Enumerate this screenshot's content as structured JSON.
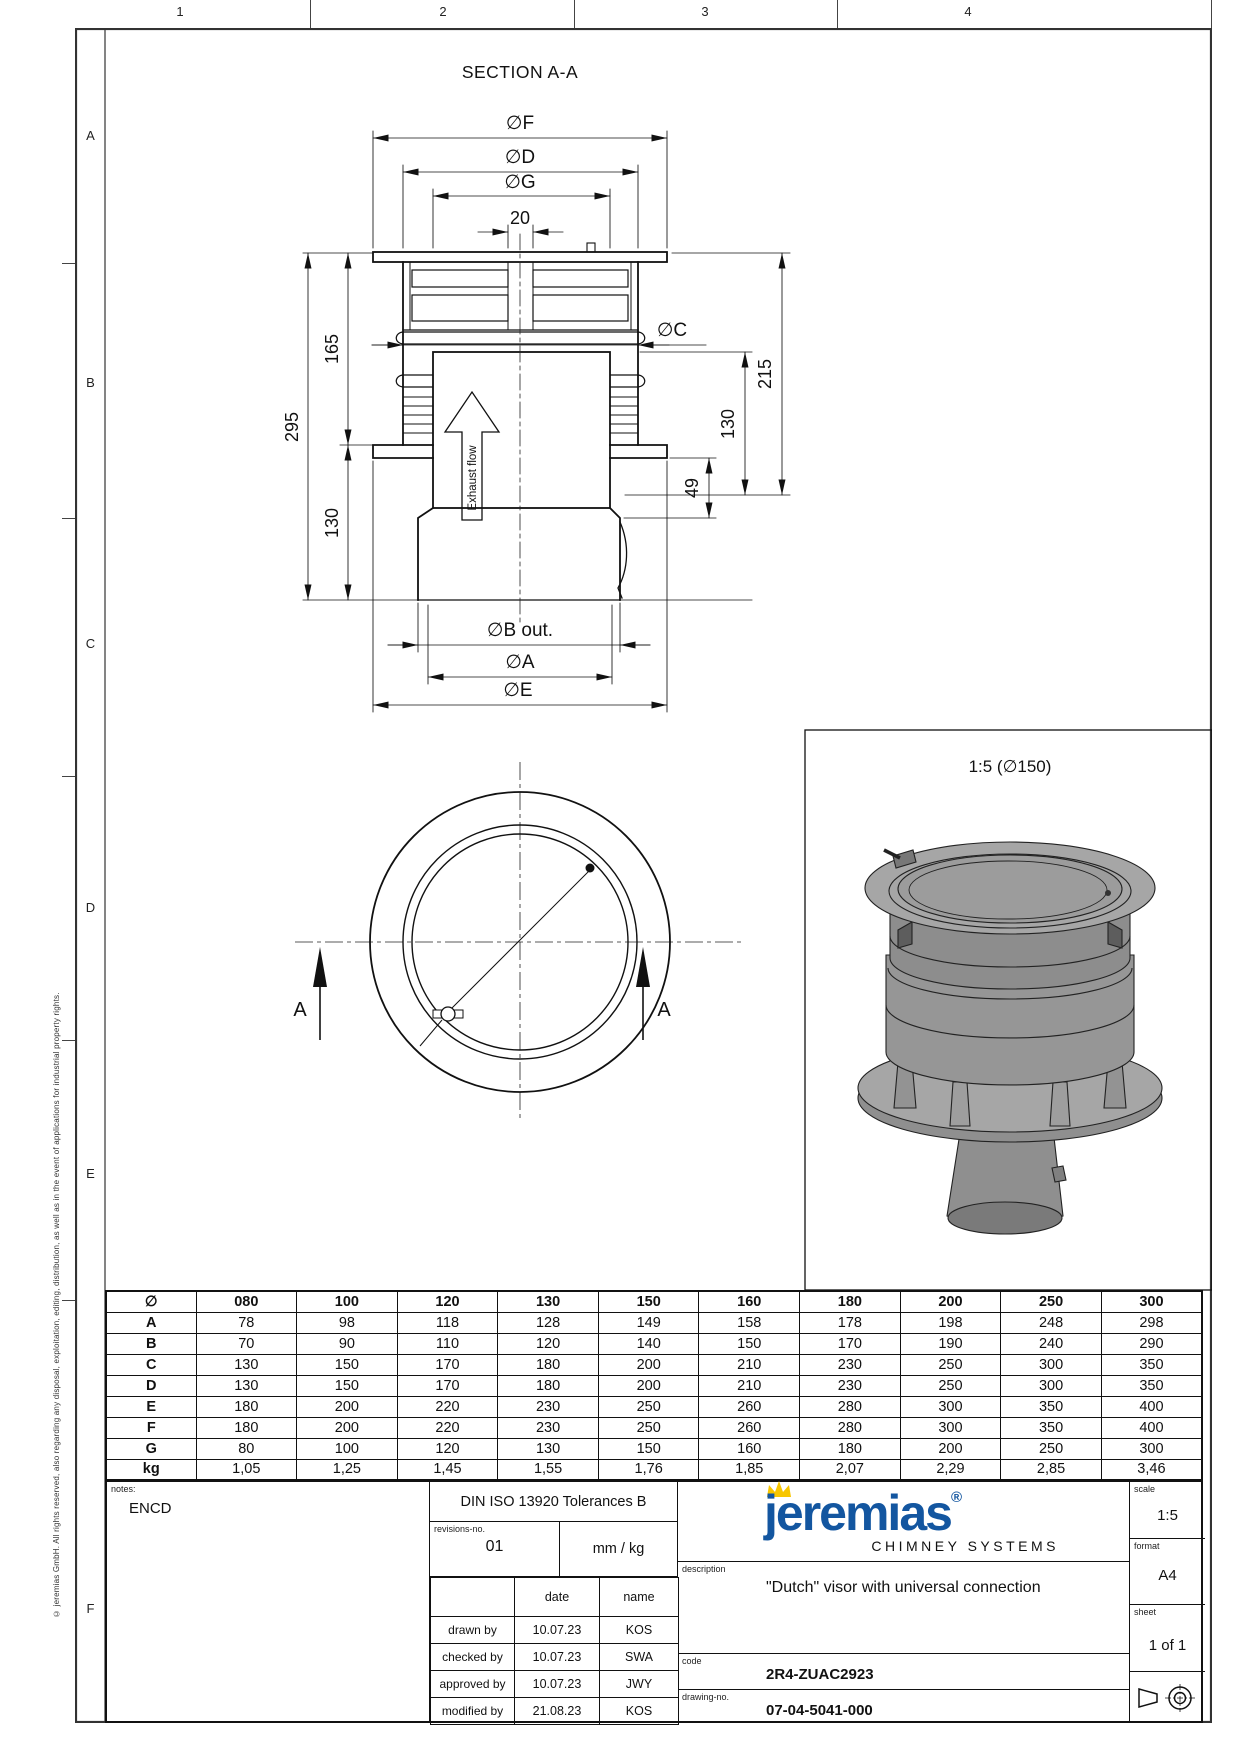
{
  "frame": {
    "col_labels": [
      "1",
      "2",
      "3",
      "4"
    ],
    "row_labels": [
      "A",
      "B",
      "C",
      "D",
      "E",
      "F"
    ],
    "copyright": "© jeremias GmbH. All rights reserved, also regarding any disposal, exploitation, editing, distribution, as well as in the event of applications for industrial property rights."
  },
  "section_view": {
    "title": "SECTION A-A",
    "labels": {
      "dia_f": "∅F",
      "dia_d": "∅D",
      "dia_g": "∅G",
      "w20": "20",
      "h295": "295",
      "h165": "165",
      "h130_left": "130",
      "dia_c": "∅C",
      "h215": "215",
      "h130_right": "130",
      "h49": "49",
      "dia_b_out": "∅B out.",
      "dia_a": "∅A",
      "dia_e": "∅E",
      "exhaust": "Exhaust flow",
      "cut_a_left": "A",
      "cut_a_right": "A"
    }
  },
  "detail_view": {
    "caption": "1:5 (∅150)"
  },
  "size_table": {
    "header": [
      "∅",
      "080",
      "100",
      "120",
      "130",
      "150",
      "160",
      "180",
      "200",
      "250",
      "300"
    ],
    "rows": [
      {
        "label": "A",
        "values": [
          "78",
          "98",
          "118",
          "128",
          "149",
          "158",
          "178",
          "198",
          "248",
          "298"
        ]
      },
      {
        "label": "B",
        "values": [
          "70",
          "90",
          "110",
          "120",
          "140",
          "150",
          "170",
          "190",
          "240",
          "290"
        ]
      },
      {
        "label": "C",
        "values": [
          "130",
          "150",
          "170",
          "180",
          "200",
          "210",
          "230",
          "250",
          "300",
          "350"
        ]
      },
      {
        "label": "D",
        "values": [
          "130",
          "150",
          "170",
          "180",
          "200",
          "210",
          "230",
          "250",
          "300",
          "350"
        ]
      },
      {
        "label": "E",
        "values": [
          "180",
          "200",
          "220",
          "230",
          "250",
          "260",
          "280",
          "300",
          "350",
          "400"
        ]
      },
      {
        "label": "F",
        "values": [
          "180",
          "200",
          "220",
          "230",
          "250",
          "260",
          "280",
          "300",
          "350",
          "400"
        ]
      },
      {
        "label": "G",
        "values": [
          "80",
          "100",
          "120",
          "130",
          "150",
          "160",
          "180",
          "200",
          "250",
          "300"
        ]
      },
      {
        "label": "kg",
        "values": [
          "1,05",
          "1,25",
          "1,45",
          "1,55",
          "1,76",
          "1,85",
          "2,07",
          "2,29",
          "2,85",
          "3,46"
        ]
      }
    ]
  },
  "title_block": {
    "notes_label": "notes:",
    "notes_value": "ENCD",
    "tolerance": "DIN ISO 13920 Tolerances B",
    "revisions_label": "revisions-no.",
    "revisions_value": "01",
    "units": "mm / kg",
    "date_header": "date",
    "name_header": "name",
    "signoff_rows": [
      {
        "role": "drawn by",
        "date": "10.07.23",
        "name": "KOS"
      },
      {
        "role": "checked by",
        "date": "10.07.23",
        "name": "SWA"
      },
      {
        "role": "approved by",
        "date": "10.07.23",
        "name": "JWY"
      },
      {
        "role": "modified by",
        "date": "21.08.23",
        "name": "KOS"
      }
    ],
    "brand": {
      "name": "jeremias",
      "registered": "®",
      "tagline": "CHIMNEY SYSTEMS",
      "blue": "#1356a0",
      "yellow": "#f7c600"
    },
    "description_label": "description",
    "description_value": "\"Dutch\" visor with universal connection",
    "code_label": "code",
    "code_value": "2R4-ZUAC2923",
    "drawing_no_label": "drawing-no.",
    "drawing_no_value": "07-04-5041-000",
    "scale_label": "scale",
    "scale_value": "1:5",
    "format_label": "format",
    "format_value": "A4",
    "sheet_label": "sheet",
    "sheet_value": "1 of 1"
  }
}
